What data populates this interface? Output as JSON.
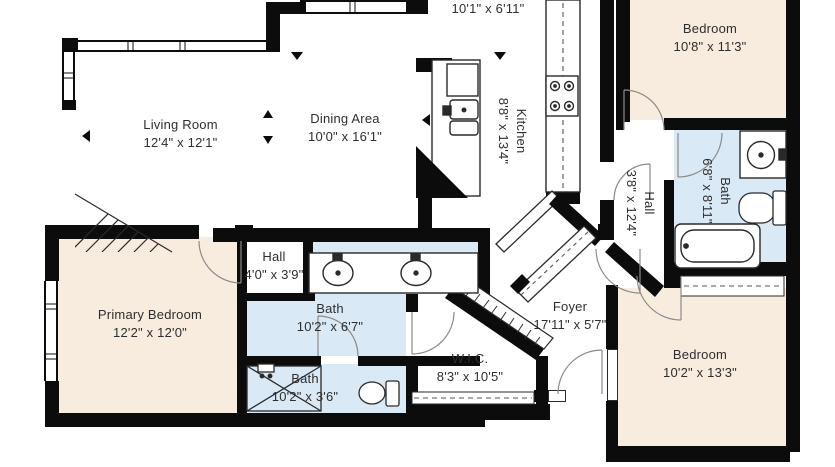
{
  "plan": {
    "type": "floor-plan",
    "colors": {
      "wall": "#0c0c0c",
      "bedroom_fill": "#f8ecdf",
      "bath_fill": "#d9e9f6",
      "linework": "#2a2a2a",
      "door_arc": "#8a8a8a",
      "label_text": "#2e2e2e"
    },
    "fixture_icons": [
      "stove-icon",
      "kitchen-sink-icon",
      "double-vanity-sink-icon",
      "round-sink-icon",
      "toilet-icon",
      "bathtub-icon",
      "shower-icon",
      "stairs-icon",
      "door-swing-icon",
      "window-icon",
      "closet-rod-icon",
      "closet-shelf-icon"
    ]
  },
  "rooms": {
    "breakfast": {
      "name": "Breakfast Room",
      "dims": "10'1\" x 6'11\""
    },
    "living_room": {
      "name": "Living Room",
      "dims": "12'4\" x 12'1\""
    },
    "dining_area": {
      "name": "Dining Area",
      "dims": "10'0\" x 16'1\""
    },
    "kitchen": {
      "name": "Kitchen",
      "dims": "8'8\" x 13'4\""
    },
    "bedroom_top_right": {
      "name": "Bedroom",
      "dims": "10'8\" x 11'3\""
    },
    "bath_right": {
      "name": "Bath",
      "dims": "6'8\" x 8'11\""
    },
    "hall_right": {
      "name": "Hall",
      "dims": "3'8\" x 12'4\""
    },
    "hall_center": {
      "name": "Hall",
      "dims": "4'0\" x 3'9\""
    },
    "bath_primary": {
      "name": "Bath",
      "dims": "10'2\" x 6'7\""
    },
    "bath_small": {
      "name": "Bath",
      "dims": "10'2\" x 3'6\""
    },
    "wic": {
      "name": "W.I.C.",
      "dims": "8'3\" x 10'5\""
    },
    "foyer": {
      "name": "Foyer",
      "dims": "17'11\" x 5'7\""
    },
    "primary_bedroom": {
      "name": "Primary Bedroom",
      "dims": "12'2\" x 12'0\""
    },
    "bedroom_bottom_right": {
      "name": "Bedroom",
      "dims": "10'2\" x 13'3\""
    }
  }
}
